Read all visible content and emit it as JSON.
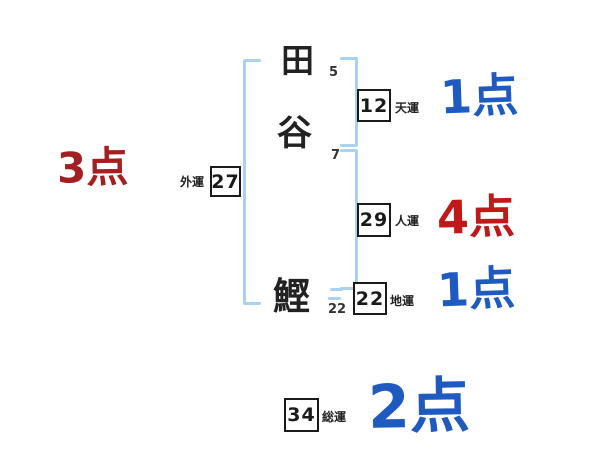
{
  "diagram": {
    "type": "name-fortune-chart",
    "name_characters": [
      {
        "char": "田",
        "strokes": "5"
      },
      {
        "char": "谷",
        "strokes": "7"
      },
      {
        "char": "鰹",
        "strokes": "22"
      }
    ],
    "fortunes": {
      "outer": {
        "label": "外運",
        "value": "27",
        "score": "3点",
        "score_color": "#a42020"
      },
      "heaven": {
        "label": "天運",
        "value": "12",
        "score": "1点",
        "score_color": "#1e5ac0"
      },
      "person": {
        "label": "人運",
        "value": "29",
        "score": "4点",
        "score_color": "#c11818"
      },
      "earth": {
        "label": "地運",
        "value": "22",
        "score": "1点",
        "score_color": "#1e5ac0"
      },
      "total": {
        "label": "総運",
        "value": "34",
        "score": "2点",
        "score_color": "#1e5ac0"
      }
    },
    "colors": {
      "bracket": "#a8d2ee",
      "ink": "#1a1a1a",
      "background": "#ffffff"
    }
  }
}
